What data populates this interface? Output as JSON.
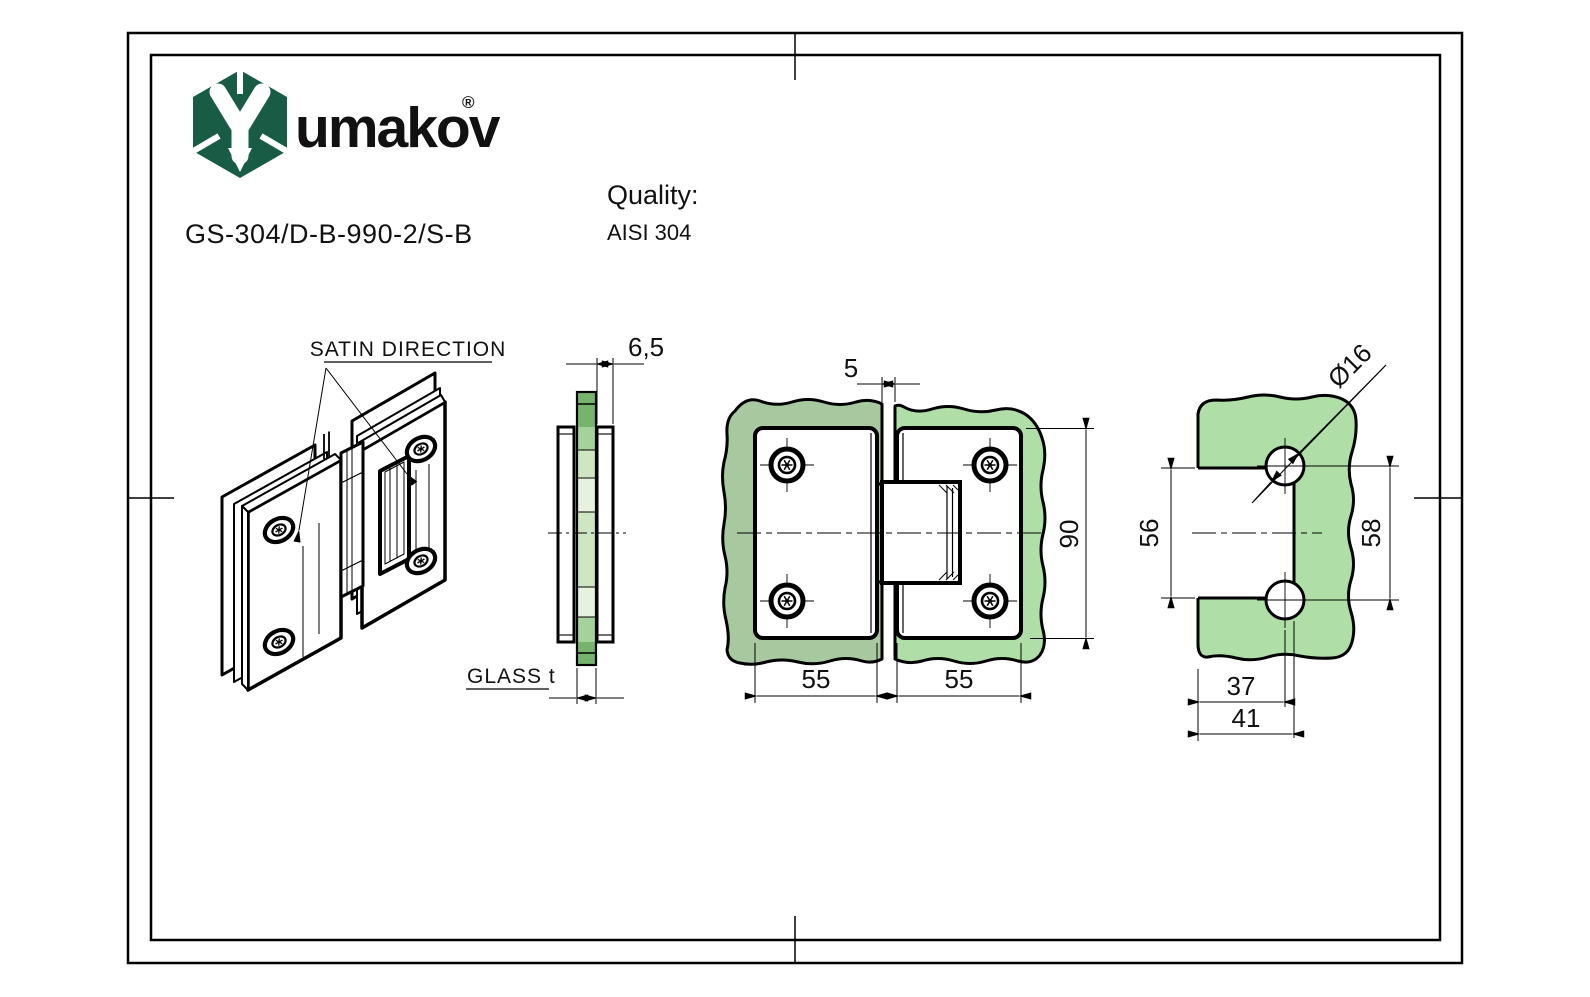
{
  "header": {
    "logo_text": "umakov",
    "registered_mark": "®",
    "part_number": "GS-304/D-B-990-2/S-B",
    "quality_label": "Quality:",
    "quality_value": "AISI 304"
  },
  "labels": {
    "satin_direction": "SATIN DIRECTION",
    "glass_thickness": "GLASS t"
  },
  "dimensions": {
    "plate_thickness": "6,5",
    "glass_gap": "5",
    "hinge_height": "90",
    "plate_width_left": "55",
    "plate_width_right": "55",
    "hole_diameter": "Ø16",
    "cutout_height": "56",
    "hole_pitch": "58",
    "hole_center_offset": "37",
    "cutout_depth": "41"
  },
  "colors": {
    "logo_green": "#185C45",
    "glass_front_left": "#a8c8a0",
    "glass_front_right": "#afdfa7",
    "glass_cutout": "#afdfa7",
    "side_glass_dark": "#76b46e",
    "side_glass_mid": "#a4d29a",
    "side_glass_light": "#cde7c2",
    "side_glass_pale": "#e6f2dd"
  }
}
